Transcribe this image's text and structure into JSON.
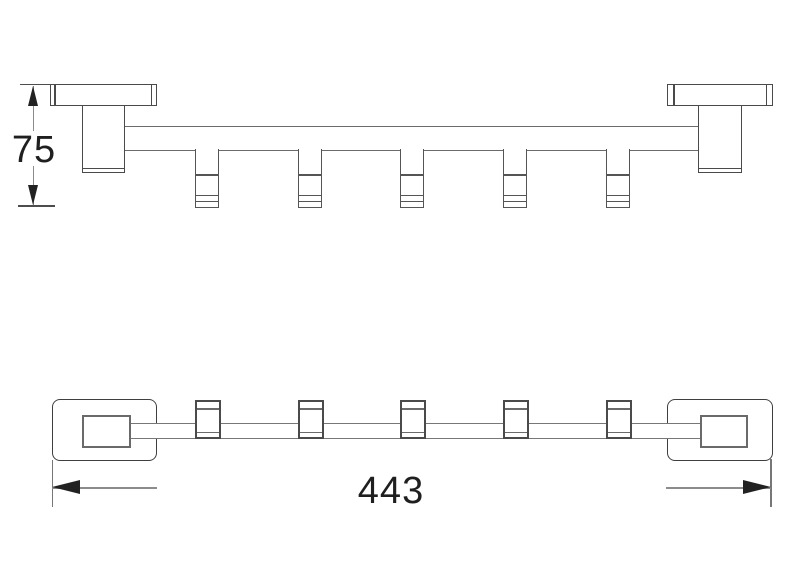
{
  "drawing": {
    "dimensions": {
      "height_mm": "75",
      "width_mm": "443"
    },
    "colors": {
      "background": "#ffffff",
      "outline": "#4a4a4a",
      "outline_light": "#6b6b6b",
      "dimension_line": "#8c8c8c",
      "arrow": "#222222",
      "text": "#1f1f1f"
    },
    "front_view": {
      "hook_count": 5
    },
    "plan_view": {
      "hook_count": 5
    }
  }
}
